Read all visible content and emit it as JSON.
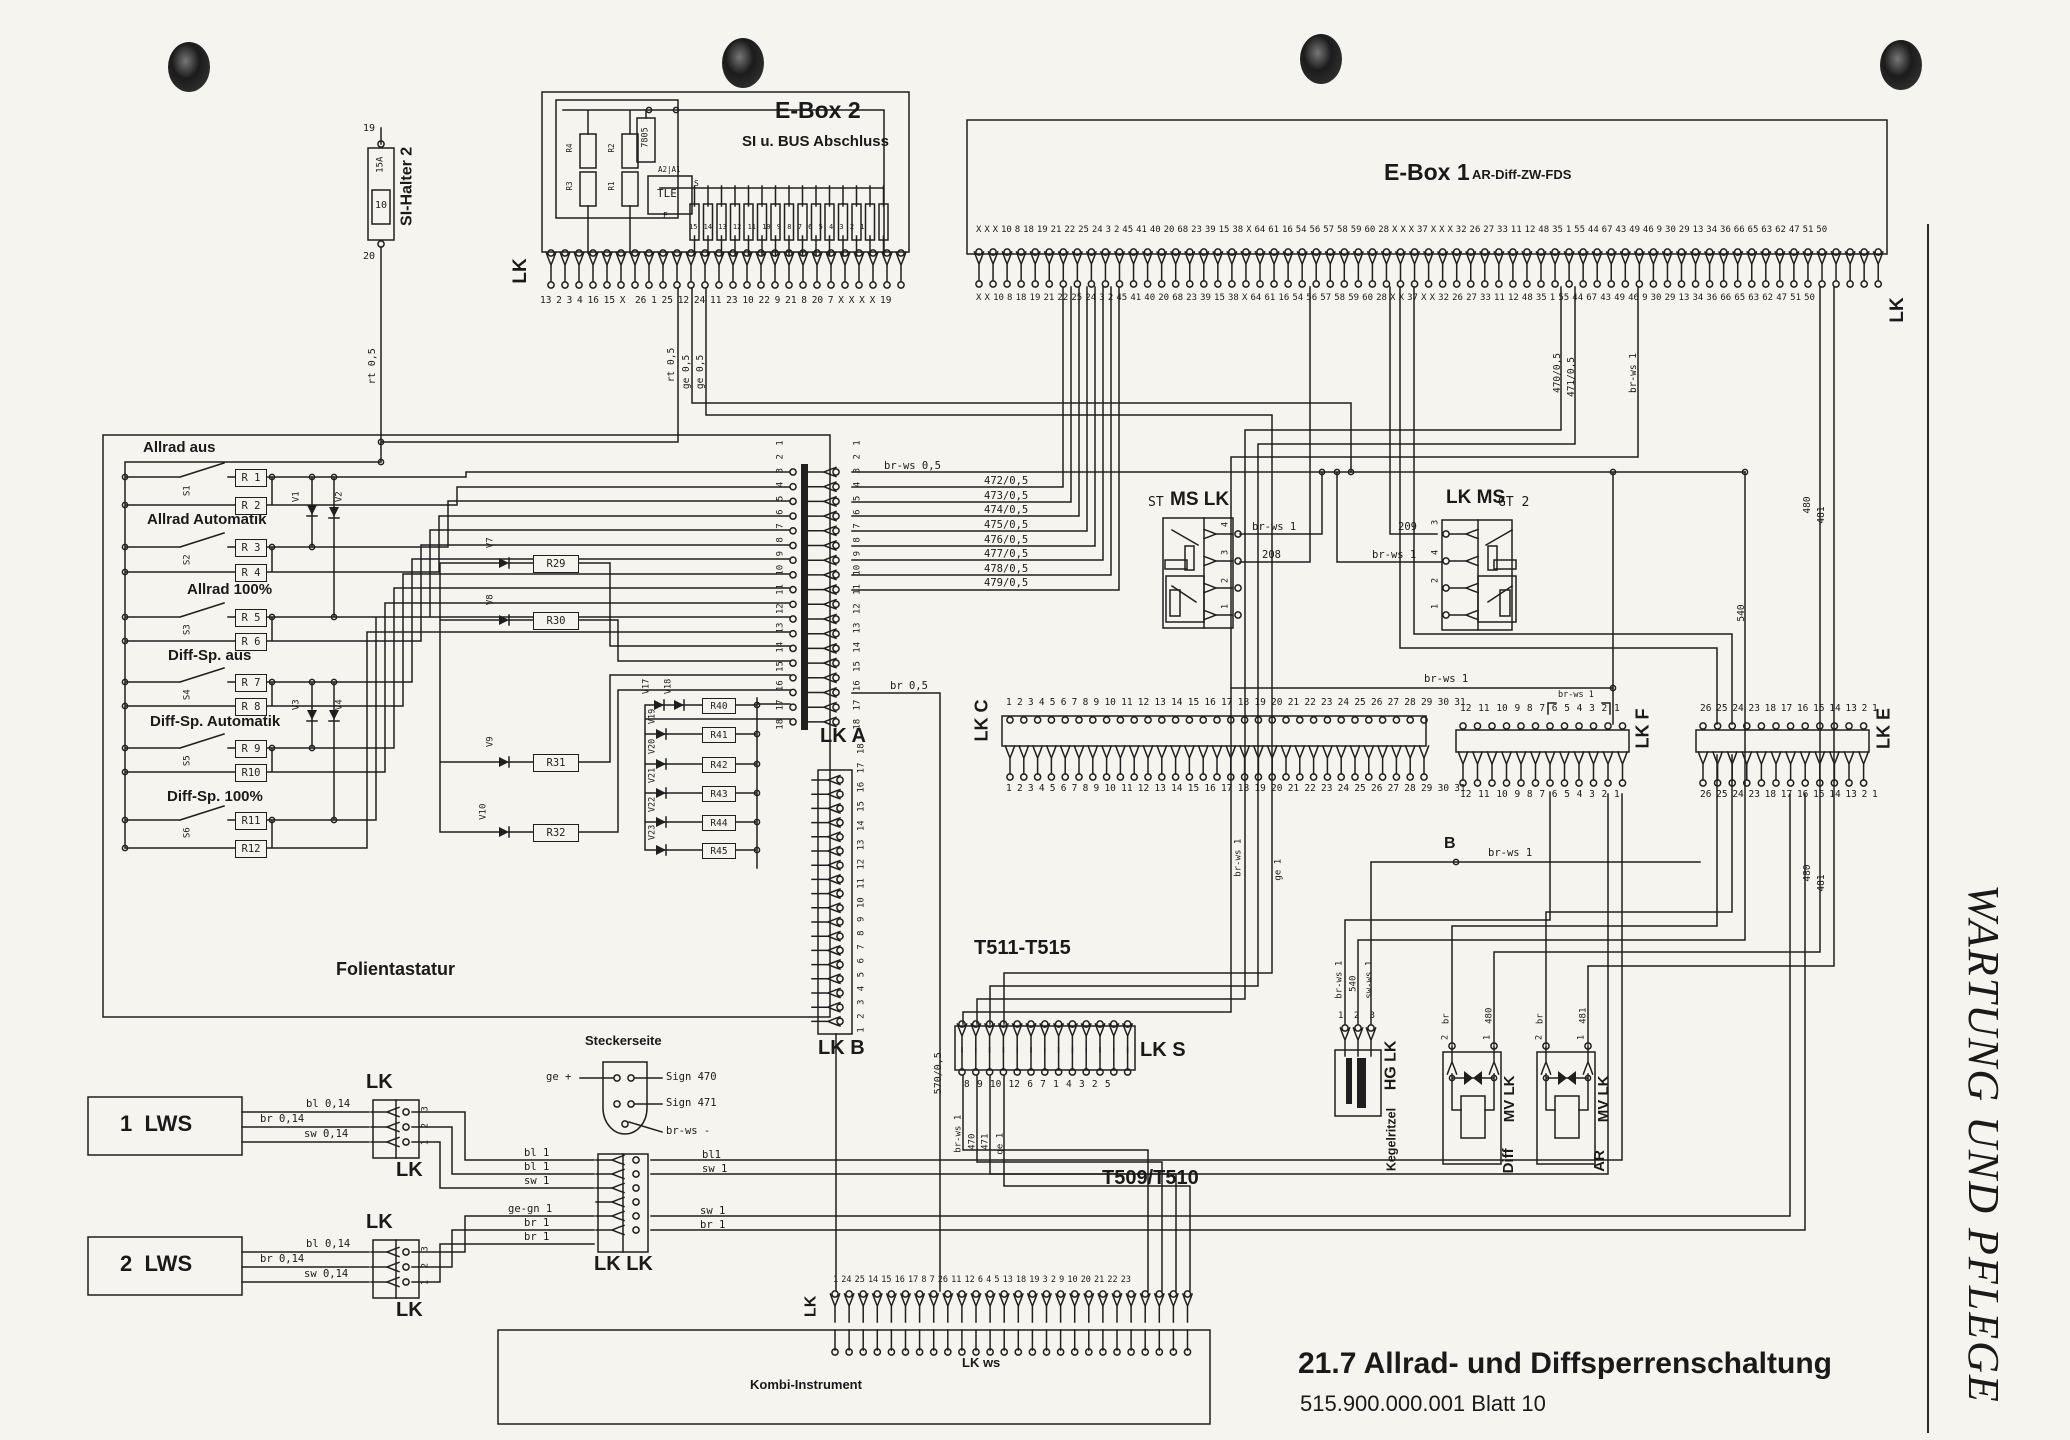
{
  "page": {
    "title": "21.7 Allrad- und Diffsperrenschaltung",
    "doc_number": "515.900.000.001 Blatt 10",
    "side_banner": "WARTUNG UND PFLEGE",
    "paper_color": "#f6f4ee",
    "ink_color": "#1f1f1f"
  },
  "si_halter": {
    "name": "SI-Halter 2",
    "pin_top": "19",
    "pin_bottom": "20",
    "fuse": "15A",
    "slot": "10"
  },
  "ebox2": {
    "title": "E-Box 2",
    "subtitle": "SI u. BUS Abschluss",
    "lk": "LK",
    "regulator": "7805",
    "ic": "TLE",
    "ic_pins": "A2|A1",
    "pin_s": "S",
    "pin_f": "F",
    "r1": "R1",
    "r2": "R2",
    "r3": "R3",
    "r4": "R4",
    "strip_numbers": "15 14 13 12 11 10 9 8 7 6 5 4 3 2 1",
    "pin_row": "13 2 3 4 16 15 X  26 1 25 12 24 11 23 10 22 9 21 8 20 7 X X X X 19",
    "drop1": "rt 0,5",
    "drop2": "ge 0,5",
    "drop3": "ge 0,5"
  },
  "ebox1": {
    "title": "E-Box 1",
    "subtitle": "AR-Diff-ZW-FDS",
    "lk": "LK",
    "pin_row_top": "X X X 10 8 18 19 21 22 25 24 3 2 45 41 40 20 68 23 39 15 38 X 64 61 16 54 56 57 58 59 60 28 X X X 37 X X X 32 26 27 33 11 12 48 35 1 55 44 67 43 49 46 9 30 29 13 34 36 66 65 63 62 47 51 50",
    "pin_row_bottom": "X X 10 8 18 19 21 22 25 24 3 2 45 41 40 20 68 23 39 15 38 X 64 61 16 54 56 57 58 59 60 28 X X 37 X X 32 26 27 33 11 12 48 35 1 55 44 67 43 49 46 9 30 29 13 34 36 66 65 63 62 47 51 50"
  },
  "keypad": {
    "label": "Folientastatur",
    "groups": [
      {
        "title": "Allrad aus",
        "sw": "S1",
        "ra": "R 1",
        "rb": "R 2"
      },
      {
        "title": "Allrad Automatik",
        "sw": "S2",
        "ra": "R 3",
        "rb": "R 4"
      },
      {
        "title": "Allrad 100%",
        "sw": "S3",
        "ra": "R 5",
        "rb": "R 6"
      },
      {
        "title": "Diff-Sp. aus",
        "sw": "S4",
        "ra": "R 7",
        "rb": "R 8"
      },
      {
        "title": "Diff-Sp. Automatik",
        "sw": "S5",
        "ra": "R 9",
        "rb": "R10"
      },
      {
        "title": "Diff-Sp. 100%",
        "sw": "S6",
        "ra": "R11",
        "rb": "R12"
      }
    ],
    "diodes": [
      "V1",
      "V2",
      "V3",
      "V4"
    ]
  },
  "matrix": {
    "rows": [
      {
        "d": "V7",
        "r": "R29"
      },
      {
        "d": "V8",
        "r": "R30"
      },
      {
        "d": "V9",
        "r": "R31"
      },
      {
        "d": "V10",
        "r": "R32"
      }
    ],
    "column_diodes": [
      "V17",
      "V18",
      "V19",
      "V20",
      "V21",
      "V22",
      "V23"
    ],
    "column_resistors": [
      "R40",
      "R41",
      "R42",
      "R43",
      "R44",
      "R45"
    ]
  },
  "lk_a": {
    "label": "LK A",
    "pins": "18 17 16 15 14 13 12 11 10 9 8 7 6 5 4 3 2 1",
    "wires": [
      "br-ws 0,5",
      "472/0,5",
      "473/0,5",
      "474/0,5",
      "475/0,5",
      "476/0,5",
      "477/0,5",
      "478/0,5",
      "479/0,5"
    ],
    "wire_bottom": "br 0,5"
  },
  "lk_b": {
    "label": "LK B",
    "pins": "1 2 3 4 5 6 7 8 9 10 11 12 13 14 15 16 17 18"
  },
  "lk_c": {
    "label": "LK C",
    "pins": "1 2 3 4 5 6 7 8 9 10 11 12 13 14 15 16 17 18 19 20 21 22 23 24 25 26 27 28 29 30 31"
  },
  "lk_f": {
    "label": "LK F",
    "pins": "12 11 10 9 8 7 6 5 4 3 2 1"
  },
  "lk_e": {
    "label": "LK E",
    "pins": "26 25 24 23 18 17 16 15 14 13 2 1"
  },
  "ms_st": {
    "title": "ST",
    "title2": "MS LK",
    "pin4": "4",
    "pin3": "3",
    "pin2": "2",
    "pin1": "1",
    "wire_pin4": "br-ws 1",
    "wire_pin3": "208"
  },
  "ms_gt": {
    "title": "LK MS",
    "title2": "GT 2",
    "pin3": "3",
    "pin4": "4",
    "pin2": "2",
    "pin1": "1",
    "wire_pin3": "209",
    "wire_pin4": "br-ws 1"
  },
  "lk_s": {
    "heading": "T511-T515",
    "label": "LK S",
    "pins": "8 9 10 12 6 7 1 4 3 2 5",
    "drops": [
      "br-ws 1",
      "470",
      "471",
      "ge 1"
    ],
    "heading2": "T509/T510"
  },
  "stecker": {
    "title": "Steckerseite",
    "wire_left": "ge +",
    "sign1": "Sign 470",
    "sign2": "Sign 471",
    "wire_bottom": "br-ws -"
  },
  "lws1": {
    "label": "1  LWS",
    "w1": "bl 0,14",
    "w2": "br 0,14",
    "w3": "sw 0,14",
    "lk_top": "LK",
    "lk_bottom": "LK",
    "pins": "1 2 3"
  },
  "lws2": {
    "label": "2  LWS",
    "w1": "bl 0,14",
    "w2": "br 0,14",
    "w3": "sw 0,14",
    "lk_top": "LK",
    "lk_bottom": "LK",
    "pins": "1 2 3"
  },
  "mid_lk": {
    "label": "LK LK",
    "inputs": [
      "bl 1",
      "bl 1",
      "sw 1",
      "ge-gn 1",
      "br 1",
      "br 1"
    ],
    "outputs": [
      "bl1",
      "sw 1",
      "sw 1",
      "br 1"
    ]
  },
  "kombi": {
    "label": "Kombi-Instrument",
    "lk": "LK",
    "lk_ws": "LK ws",
    "pins": "1 24 25 14 15 16 17 8 7 26 11 12 6 4 5 13 18 19 3 2 9 10 20 21 22 23"
  },
  "kegel": {
    "label1": "Kegelritzel",
    "label2": "HG LK",
    "pins": "1 2 3",
    "drops": [
      "br-ws 1",
      "540",
      "sw-ws 1"
    ]
  },
  "mv_diff": {
    "label1": "Diff",
    "label2": "MV LK",
    "pin2": "2",
    "pin1": "1",
    "w_pin2": "br",
    "w_pin1": "480"
  },
  "mv_ar": {
    "label1": "AR",
    "label2": "MV LK",
    "pin2": "2",
    "pin1": "1",
    "w_pin2": "br",
    "w_pin1": "481"
  },
  "floats": {
    "br_ws_05": "br-ws 0,5",
    "br_ws_1": "br-ws 1",
    "rt_05": "rt 0,5",
    "ge_05": "ge 0,5",
    "ge_1": "ge 1",
    "w470_05": "470/0,5",
    "w471_05": "471/0,5",
    "w480": "480",
    "w481": "481",
    "w540": "540",
    "w570": "570/0,5",
    "w208": "208",
    "w209": "209",
    "junction_b": "B"
  }
}
